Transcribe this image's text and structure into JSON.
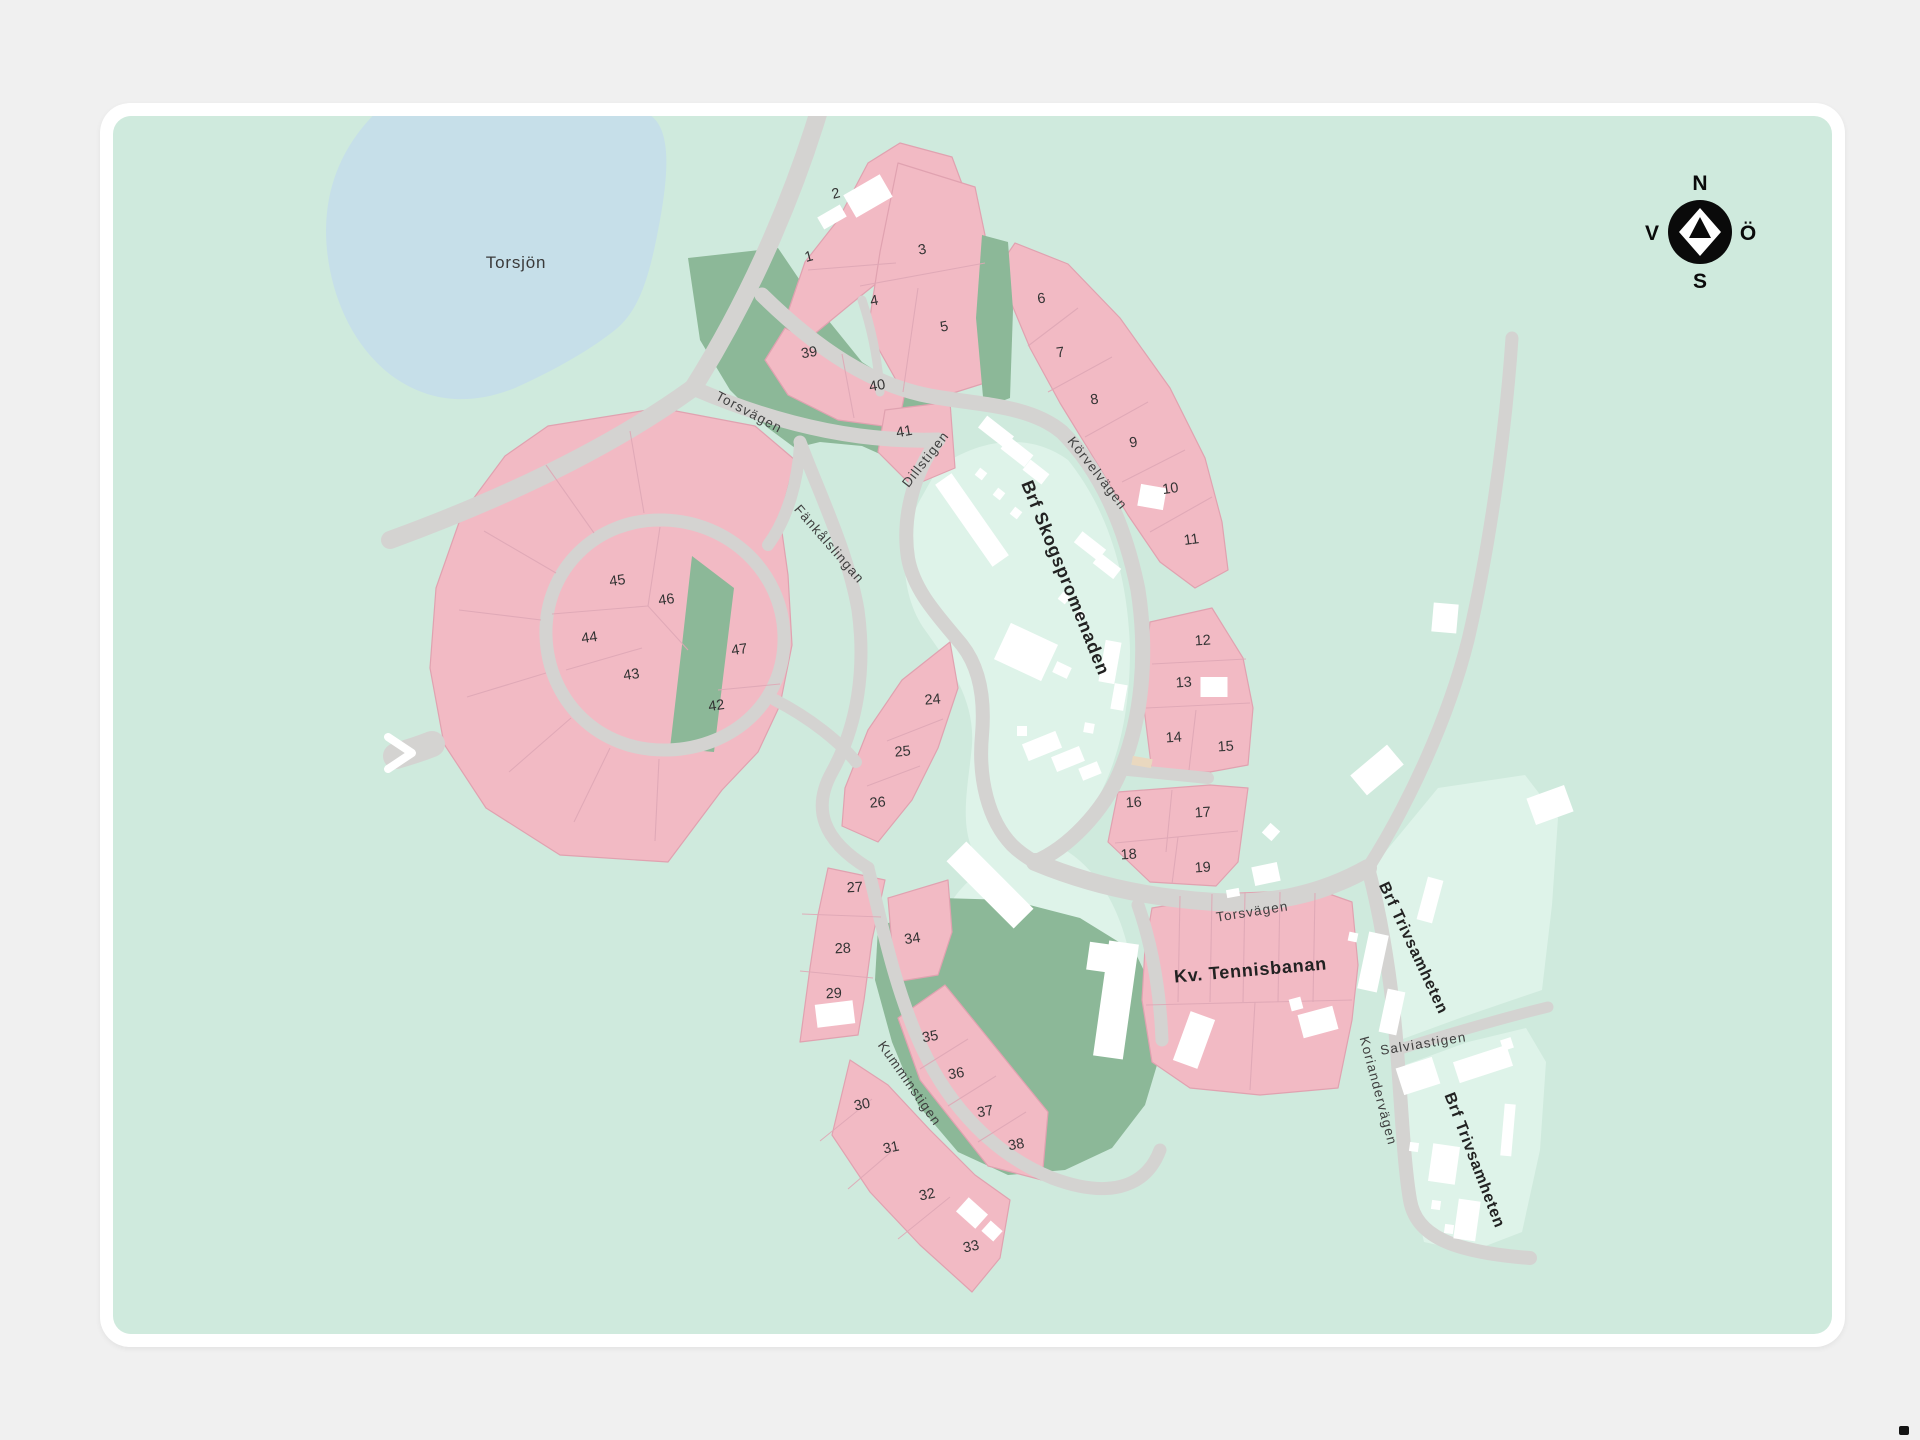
{
  "compass": {
    "north": "N",
    "south": "S",
    "west": "V",
    "east": "Ö"
  },
  "map": {
    "lake_label": "Torsjön",
    "streets": {
      "torsvagen": "Torsvägen",
      "dillstigen": "Dillstigen",
      "korvelvagen": "Körvelvägen",
      "fankalslingan": "Fänkålslingan",
      "kumminstigen": "Kumminstigen",
      "koriandervagen": "Koriandervägen",
      "salviastigen": "Salviastigen"
    },
    "areas": {
      "skogspromenaden": "Brf Skogspromenaden",
      "tennisbanan": "Kv. Tennisbanan",
      "trivsamheten": "Brf Trivsamheten"
    },
    "lots": [
      {
        "n": "1",
        "x": 810,
        "y": 261,
        "r": -15
      },
      {
        "n": "2",
        "x": 837,
        "y": 198,
        "r": -15
      },
      {
        "n": "3",
        "x": 923,
        "y": 254,
        "r": -10
      },
      {
        "n": "4",
        "x": 875,
        "y": 305,
        "r": -10
      },
      {
        "n": "5",
        "x": 945,
        "y": 331,
        "r": -10
      },
      {
        "n": "6",
        "x": 1042,
        "y": 303,
        "r": -8
      },
      {
        "n": "7",
        "x": 1061,
        "y": 357,
        "r": -8
      },
      {
        "n": "8",
        "x": 1095,
        "y": 404,
        "r": -8
      },
      {
        "n": "9",
        "x": 1134,
        "y": 447,
        "r": -8
      },
      {
        "n": "10",
        "x": 1171,
        "y": 493,
        "r": -8
      },
      {
        "n": "11",
        "x": 1192,
        "y": 544,
        "r": -8
      },
      {
        "n": "12",
        "x": 1203,
        "y": 645,
        "r": -4
      },
      {
        "n": "13",
        "x": 1184,
        "y": 687,
        "r": -4
      },
      {
        "n": "14",
        "x": 1174,
        "y": 742,
        "r": -4
      },
      {
        "n": "15",
        "x": 1226,
        "y": 751,
        "r": -4
      },
      {
        "n": "16",
        "x": 1134,
        "y": 807,
        "r": -4
      },
      {
        "n": "17",
        "x": 1203,
        "y": 817,
        "r": -4
      },
      {
        "n": "18",
        "x": 1129,
        "y": 859,
        "r": -4
      },
      {
        "n": "19",
        "x": 1203,
        "y": 872,
        "r": -4
      },
      {
        "n": "24",
        "x": 933,
        "y": 704,
        "r": -5
      },
      {
        "n": "25",
        "x": 903,
        "y": 756,
        "r": -5
      },
      {
        "n": "26",
        "x": 878,
        "y": 807,
        "r": -5
      },
      {
        "n": "27",
        "x": 855,
        "y": 892,
        "r": -3
      },
      {
        "n": "28",
        "x": 843,
        "y": 953,
        "r": -3
      },
      {
        "n": "29",
        "x": 834,
        "y": 998,
        "r": -3
      },
      {
        "n": "30",
        "x": 863,
        "y": 1109,
        "r": -12
      },
      {
        "n": "31",
        "x": 892,
        "y": 1152,
        "r": -12
      },
      {
        "n": "32",
        "x": 928,
        "y": 1199,
        "r": -12
      },
      {
        "n": "33",
        "x": 972,
        "y": 1251,
        "r": -12
      },
      {
        "n": "34",
        "x": 913,
        "y": 943,
        "r": -8
      },
      {
        "n": "35",
        "x": 931,
        "y": 1041,
        "r": -10
      },
      {
        "n": "36",
        "x": 957,
        "y": 1078,
        "r": -10
      },
      {
        "n": "37",
        "x": 986,
        "y": 1116,
        "r": -10
      },
      {
        "n": "38",
        "x": 1017,
        "y": 1149,
        "r": -10
      },
      {
        "n": "39",
        "x": 810,
        "y": 357,
        "r": -10
      },
      {
        "n": "40",
        "x": 878,
        "y": 390,
        "r": -10
      },
      {
        "n": "41",
        "x": 905,
        "y": 436,
        "r": -10
      },
      {
        "n": "42",
        "x": 717,
        "y": 710,
        "r": -8
      },
      {
        "n": "43",
        "x": 632,
        "y": 679,
        "r": -8
      },
      {
        "n": "44",
        "x": 590,
        "y": 642,
        "r": -8
      },
      {
        "n": "45",
        "x": 618,
        "y": 585,
        "r": -8
      },
      {
        "n": "46",
        "x": 667,
        "y": 604,
        "r": -8
      },
      {
        "n": "47",
        "x": 740,
        "y": 654,
        "r": -8
      }
    ],
    "colors": {
      "page_bg": "#f0f0f0",
      "card_bg": "#ffffff",
      "map_bg": "#cfeadd",
      "map_bg_light": "#def3e9",
      "lake": "#c6dfe9",
      "road": "#d4d3d1",
      "lot_fill": "#f2bac4",
      "lot_border": "#e0a2b0",
      "lot_divider": "#dfa8b6",
      "park": "#8cb898",
      "building": "#ffffff",
      "accent_beige": "#e9d8bf",
      "label_dark": "#222222",
      "label_street": "#3f3f3f",
      "compass": "#0a0a0a"
    }
  }
}
